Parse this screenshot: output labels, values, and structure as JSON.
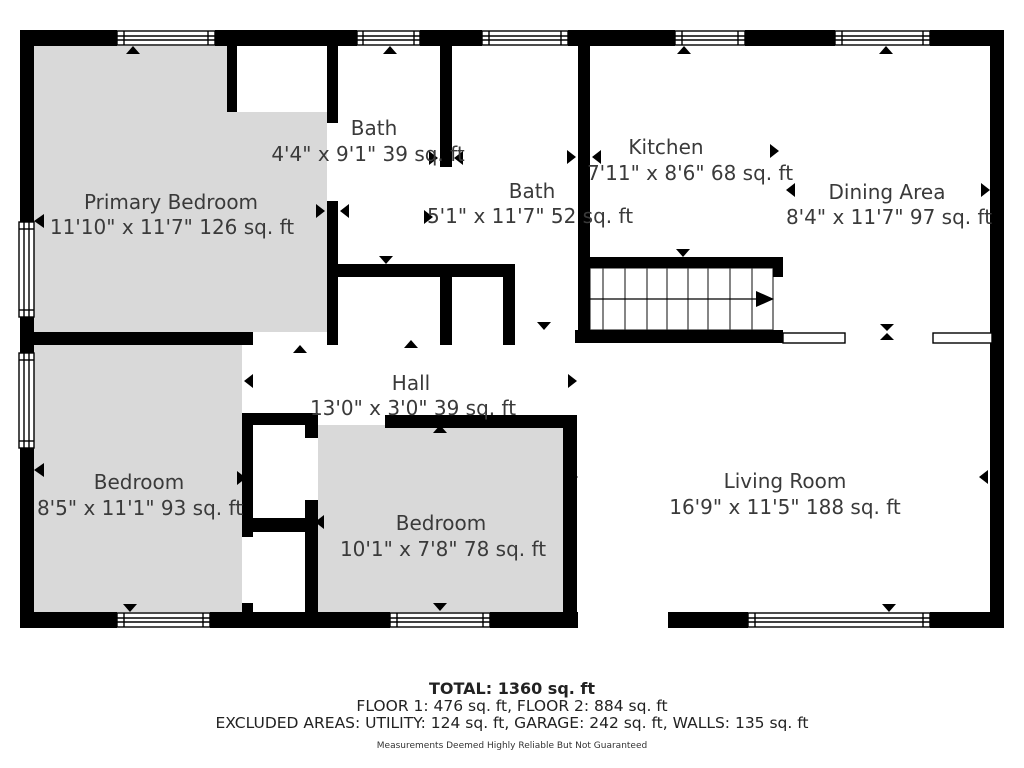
{
  "floor_plan": {
    "colors": {
      "wall": "#000000",
      "bedroom_fill": "#d9d9d9",
      "background": "#ffffff",
      "label_text": "#3a3a3a"
    },
    "rooms": [
      {
        "id": "primary-bedroom",
        "name": "Primary Bedroom",
        "dims": "11'10\" x 11'7\" 126 sq. ft"
      },
      {
        "id": "bath-upper",
        "name": "Bath",
        "dims": "4'4\" x 9'1\" 39 sq. ft"
      },
      {
        "id": "bath-lower",
        "name": "Bath",
        "dims": "5'1\" x 11'7\" 52 sq. ft"
      },
      {
        "id": "kitchen",
        "name": "Kitchen",
        "dims": "7'11\" x 8'6\" 68 sq. ft"
      },
      {
        "id": "dining-area",
        "name": "Dining Area",
        "dims": "8'4\" x 11'7\" 97 sq. ft"
      },
      {
        "id": "hall",
        "name": "Hall",
        "dims": "13'0\" x 3'0\" 39 sq. ft"
      },
      {
        "id": "bedroom-left",
        "name": "Bedroom",
        "dims": "8'5\" x 11'1\" 93 sq. ft"
      },
      {
        "id": "bedroom-middle",
        "name": "Bedroom",
        "dims": "10'1\" x 7'8\" 78 sq. ft"
      },
      {
        "id": "living-room",
        "name": "Living Room",
        "dims": "16'9\" x 11'5\" 188 sq. ft"
      }
    ],
    "footer": {
      "total": "TOTAL: 1360 sq. ft",
      "floors": "FLOOR 1: 476 sq. ft, FLOOR 2: 884 sq. ft",
      "excluded": "EXCLUDED AREAS: UTILITY: 124 sq. ft, GARAGE: 242 sq. ft, WALLS: 135 sq. ft",
      "disclaimer": "Measurements Deemed Highly Reliable But Not Guaranteed"
    }
  }
}
